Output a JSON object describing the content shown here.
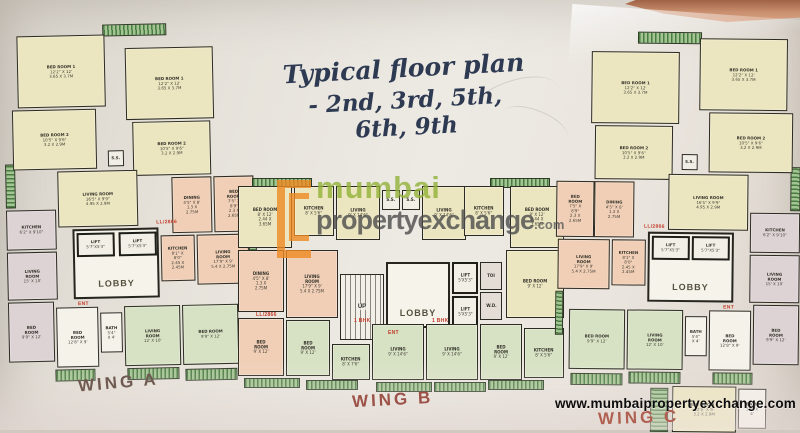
{
  "photo": {
    "website": "www.mumbaipropertyexchange.com"
  },
  "title": {
    "line1": "Typical floor plan",
    "line2": "- 2nd, 3rd, 5th, 6th, 9th"
  },
  "watermark": {
    "word1": "mumbai",
    "word2": "propertyexchange",
    "tld": ".com"
  },
  "wings": {
    "a": "WING A",
    "b": "WING B",
    "c": "WING C"
  },
  "colors": {
    "paper": "#e9e5de",
    "walls": "#2c2b23",
    "room_cream": "#ece6c0",
    "room_salmon": "#f0cfb6",
    "room_green": "#d7e2c4",
    "room_gray": "#ddd3d4",
    "balcony_green": "#4a7c42",
    "title_ink": "#2e3a52",
    "brand_orange": "#ee8a22",
    "brand_green": "#93b339",
    "wing_label": "#9c5247",
    "annotation_red": "#c23a2a"
  },
  "rooms": {
    "a1": {
      "n": "BED ROOM 1",
      "d": "12'2\" X 12'",
      "m": "3.65 X 3.7M"
    },
    "a2": {
      "n": "BED ROOM 2",
      "d": "10'5\" X 9'6\"",
      "m": "3.2 X 2.9M"
    },
    "a5": {
      "n": "LIVING ROOM",
      "d": "16'5\" X 9'9\"",
      "m": "4.95 X 2.9M"
    },
    "a7": {
      "n": "KITCHEN",
      "d": "6'2\" X 9'10\""
    },
    "a8": {
      "n": "LIVING ROOM",
      "d": "15' X 10'"
    },
    "a9": {
      "n": "DINING",
      "d": "4'5\" X 8'",
      "m": "1.3 X 2.75M"
    },
    "a10": {
      "n": "LIVING ROOM",
      "d": "17'9\" X 9'",
      "m": "5.4 X 2.75M"
    },
    "a11": {
      "n": "KITCHEN",
      "d": "8'1\" X 8'0\"",
      "m": "2.45 X 2.45M"
    },
    "a12": {
      "n": "BED ROOM",
      "d": "7'5\" X 8'9\"",
      "m": "2.3 X 2.65M"
    },
    "a13": {
      "n": "BED ROOM",
      "d": "9'9\" X 12'"
    },
    "a14": {
      "n": "BED ROOM",
      "d": "12'8\" X 9'"
    },
    "a15": {
      "n": "BATH",
      "d": "5'4\" X 4'"
    },
    "a16": {
      "n": "LIVING ROOM",
      "d": "12' X 10'"
    },
    "b1": {
      "n": "BED ROOM",
      "d": "8' X 12'",
      "m": "2.44 X 3.65M"
    },
    "b2": {
      "n": "KITCHEN",
      "d": "8' X 5'6\""
    },
    "b3": {
      "n": "LIVING",
      "d": "9' X 14'6\""
    },
    "b13": {
      "n": "BED ROOM",
      "d": "9' X 12'"
    },
    "b16": {
      "n": "KITCHEN",
      "d": "8' X 7'6\""
    },
    "c17": {
      "n": "BED ROOM 1",
      "d": "12'8\" X 9'",
      "m": "3.2 X 2.9M"
    }
  },
  "labels": {
    "lobby": "LOBBY",
    "lift": "LIFT",
    "liftA": "5'7\"X5'3\"",
    "liftB": "5'X5'3\"",
    "up": "UP",
    "ss": "S.S.",
    "ent": "ENT",
    "toi": "TOI",
    "wd": "W.D.",
    "ll": "LL/2866",
    "bhk": "1 BHK",
    "balcony": "BALCONY"
  }
}
